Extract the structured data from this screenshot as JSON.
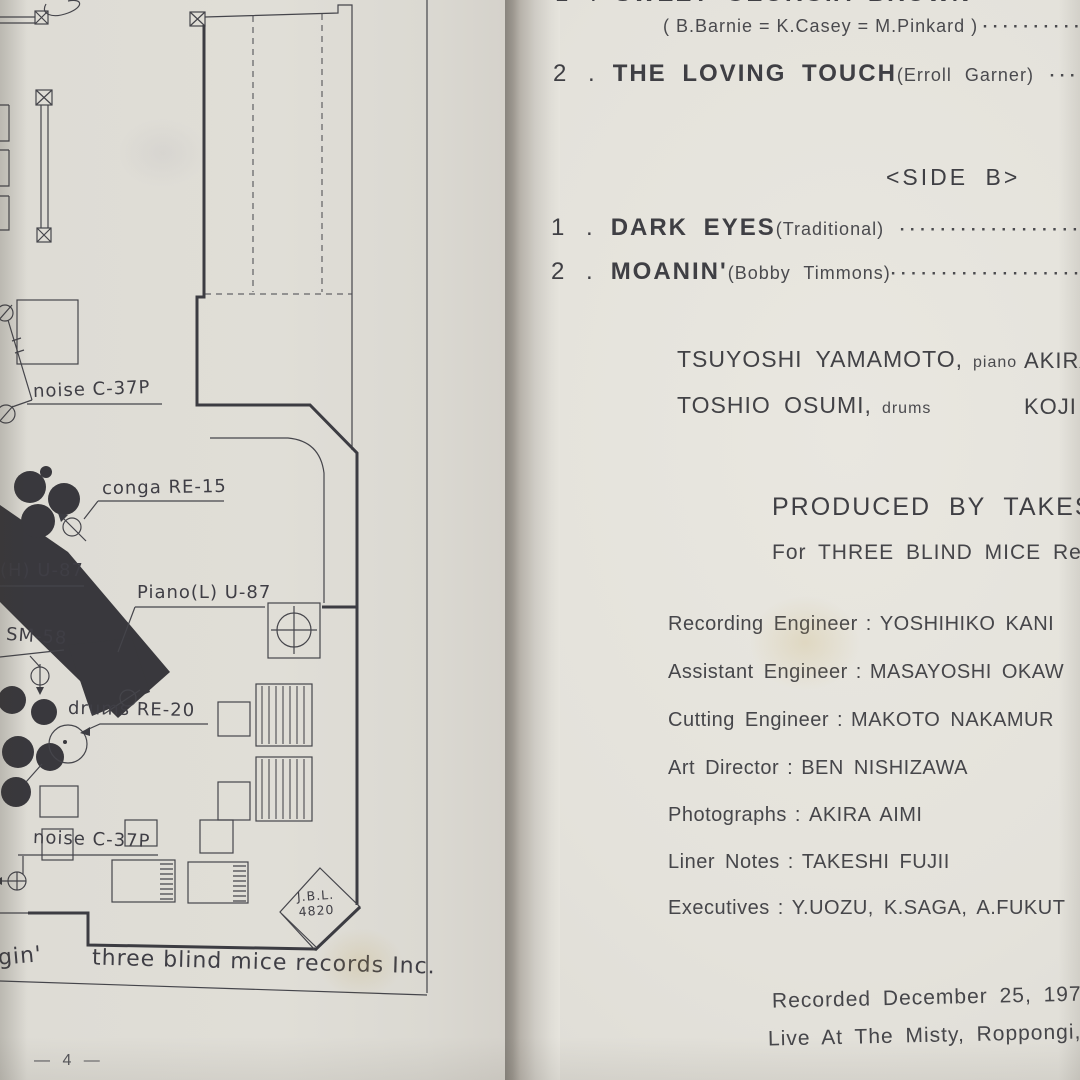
{
  "left_page": {
    "diagram_labels": {
      "noise_top": "noise C-37P",
      "conga": "conga RE-15",
      "piano_h": "(H) U-87",
      "piano_l": "Piano(L) U-87",
      "sm58": "SM-58",
      "drums": "drums RE-20",
      "noise_bottom": "noise C-37P",
      "jbl_line1": "J.B.L.",
      "jbl_line2": "4820"
    },
    "caption_fragment": "gin'",
    "caption": "three blind mice records Inc.",
    "page_number": "— 4 —"
  },
  "right_page": {
    "side_a": {
      "track1": {
        "num": "1 .",
        "title": "SWEET GEORGIA BROWN",
        "composer": "( B.Barnie = K.Casey = M.Pinkard )",
        "dots": "··············"
      },
      "track2": {
        "num": "2 .",
        "title": "THE LOVING TOUCH",
        "composer": "(Erroll Garner)",
        "dots": "············"
      }
    },
    "side_b_header": "<SIDE  B>",
    "side_b": {
      "track1": {
        "num": "1 .",
        "title": "DARK EYES",
        "composer": "(Traditional)",
        "dots": "····························"
      },
      "track2": {
        "num": "2 .",
        "title": "MOANIN'",
        "composer": "(Bobby Timmons)",
        "dots": "······························"
      }
    },
    "personnel": [
      {
        "name": "TSUYOSHI YAMAMOTO,",
        "instrument": "piano",
        "fragment": "AKIRA"
      },
      {
        "name": "TOSHIO OSUMI,",
        "instrument": "drums",
        "fragment": "KOJI"
      }
    ],
    "produced_line1": "PRODUCED BY TAKESHI",
    "produced_line2": "For THREE BLIND MICE Rec",
    "credits": [
      {
        "role": "Recording Engineer",
        "sep": ":",
        "name": "YOSHIHIKO KANI"
      },
      {
        "role": "Assistant Engineer",
        "sep": ":",
        "name": "MASAYOSHI OKAW"
      },
      {
        "role": "Cutting Engineer",
        "sep": ":",
        "name": "MAKOTO NAKAMUR"
      },
      {
        "role": "Art Director",
        "sep": ":",
        "name": "BEN NISHIZAWA"
      },
      {
        "role": "Photographs",
        "sep": ":",
        "name": "AKIRA AIMI"
      },
      {
        "role": "Liner Notes",
        "sep": ":",
        "name": "TAKESHI FUJII"
      },
      {
        "role": "Executives",
        "sep": ":",
        "name": "Y.UOZU, K.SAGA, A.FUKUT"
      }
    ],
    "footer_line1": "Recorded December 25, 1974",
    "footer_line2": "Live At The Misty, Roppongi,"
  }
}
